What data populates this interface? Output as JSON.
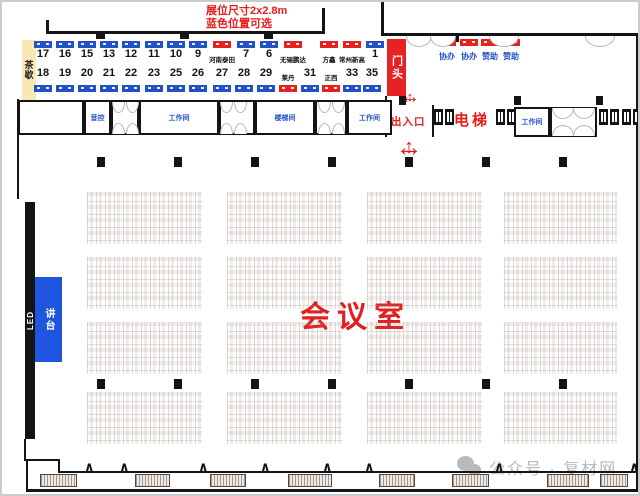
{
  "annotation": {
    "line1": "展位尺寸2x2.8m",
    "line2": "蓝色位置可选"
  },
  "labels": {
    "tea_break": "茶歇",
    "door_head": "门头",
    "entrance": "出入口",
    "elevator": "电梯",
    "hall_title": "会议室",
    "led": "LED",
    "podium": "讲台",
    "watermark": "公众号 · 复材网"
  },
  "rooms": {
    "sound_control": "音控",
    "workroom_1": "工作间",
    "stairwell": "楼梯间",
    "workroom_2": "工作间",
    "workroom_3": "工作间"
  },
  "booths": {
    "row1": [
      {
        "label": "17",
        "color": "blue"
      },
      {
        "label": "16",
        "color": "blue"
      },
      {
        "label": "15",
        "color": "blue"
      },
      {
        "label": "13",
        "color": "blue"
      },
      {
        "label": "12",
        "color": "blue"
      },
      {
        "label": "11",
        "color": "blue"
      },
      {
        "label": "10",
        "color": "blue"
      },
      {
        "label": "9",
        "color": "blue"
      },
      {
        "label": "河南泰田",
        "color": "red"
      },
      {
        "label": "7",
        "color": "blue"
      },
      {
        "label": "6",
        "color": "blue"
      },
      {
        "label": "无锡鹏达",
        "color": "red"
      },
      {
        "label": "方鑫",
        "color": "red"
      },
      {
        "label": "常州新高",
        "color": "red"
      },
      {
        "label": "1",
        "color": "blue"
      }
    ],
    "row2": [
      {
        "label": "18",
        "color": "blue"
      },
      {
        "label": "19",
        "color": "blue"
      },
      {
        "label": "20",
        "color": "blue"
      },
      {
        "label": "21",
        "color": "blue"
      },
      {
        "label": "22",
        "color": "blue"
      },
      {
        "label": "23",
        "color": "blue"
      },
      {
        "label": "25",
        "color": "blue"
      },
      {
        "label": "26",
        "color": "blue"
      },
      {
        "label": "27",
        "color": "blue"
      },
      {
        "label": "28",
        "color": "blue"
      },
      {
        "label": "29",
        "color": "blue"
      },
      {
        "label": "莱丹",
        "color": "red"
      },
      {
        "label": "31",
        "color": "blue"
      },
      {
        "label": "正西",
        "color": "red"
      },
      {
        "label": "33",
        "color": "blue"
      },
      {
        "label": "35",
        "color": "blue"
      }
    ]
  },
  "sponsors": [
    "协办",
    "协办",
    "赞助",
    "赞助"
  ],
  "colors": {
    "available_blue": "#2351c8",
    "sold_red": "#e42320",
    "accent_red": "#e81b1b",
    "tea_yellow": "#f7e8b4",
    "watermark_gray": "#8d8d8d"
  }
}
